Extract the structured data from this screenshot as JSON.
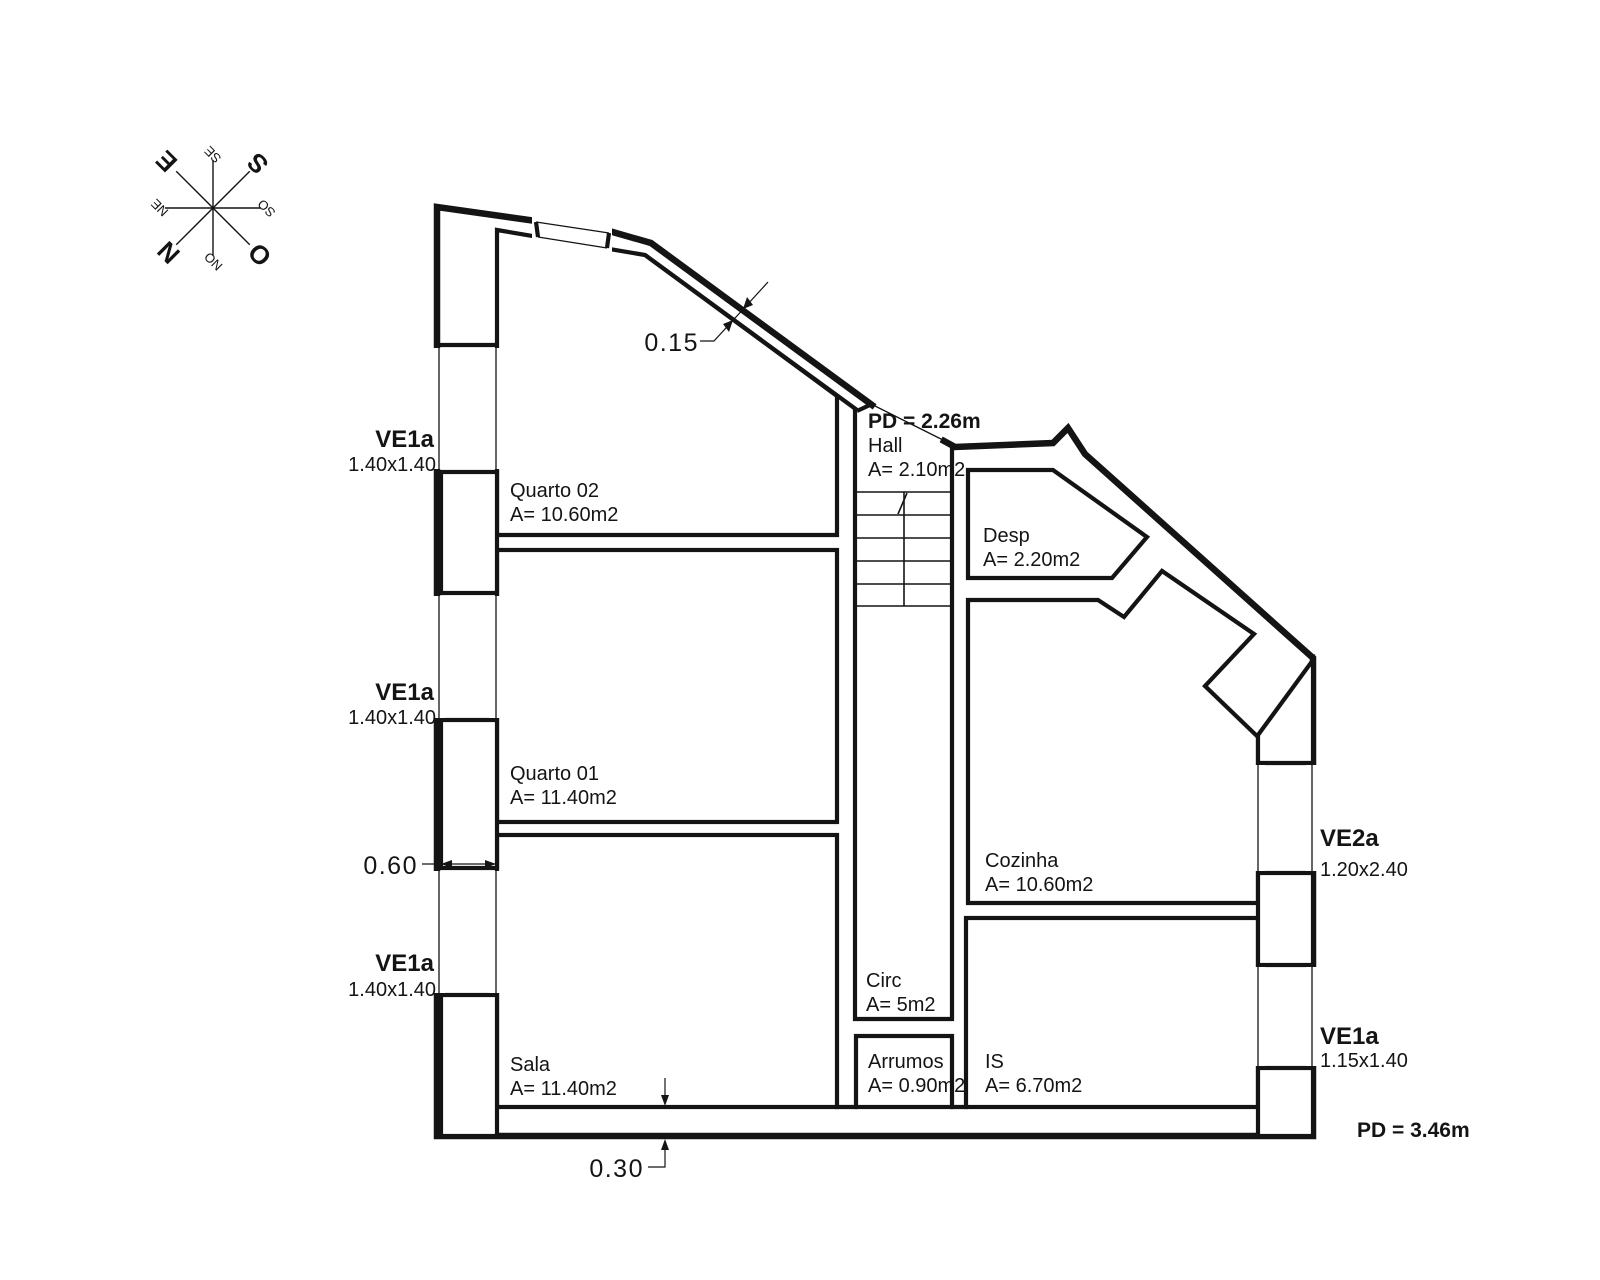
{
  "drawing": {
    "type": "floor-plan",
    "language": "pt"
  },
  "rooms": [
    {
      "name": "Quarto 02",
      "area": "A= 10.60m2"
    },
    {
      "name": "Quarto 01",
      "area": "A= 11.40m2"
    },
    {
      "name": "Sala",
      "area": "A= 11.40m2"
    },
    {
      "name": "Hall",
      "area": "A= 2.10m2"
    },
    {
      "name": "Desp",
      "area": "A= 2.20m2"
    },
    {
      "name": "Cozinha",
      "area": "A= 10.60m2"
    },
    {
      "name": "Circ",
      "area": "A= 5m2"
    },
    {
      "name": "Arrumos",
      "area": "A= 0.90m2"
    },
    {
      "name": "IS",
      "area": "A= 6.70m2"
    }
  ],
  "windows": [
    {
      "label": "VE1a",
      "size": "1.40x1.40"
    },
    {
      "label": "VE1a",
      "size": "1.40x1.40"
    },
    {
      "label": "VE1a",
      "size": "1.40x1.40"
    },
    {
      "label": "VE2a",
      "size": "1.20x2.40"
    },
    {
      "label": "VE1a",
      "size": "1.15x1.40"
    }
  ],
  "ceiling_heights": {
    "hall": "PD = 2.26m",
    "main": "PD = 3.46m"
  },
  "dimensions": {
    "wall_top": "0.15",
    "wall_left": "0.60",
    "wall_bottom": "0.30"
  },
  "compass": {
    "n": "N",
    "s": "S",
    "e": "E",
    "o": "O",
    "ne": "NE",
    "se": "SE",
    "so": "SO",
    "no": "NO"
  },
  "colors": {
    "line": "#141414",
    "dimension": "#c02b33",
    "background": "#ffffff"
  }
}
